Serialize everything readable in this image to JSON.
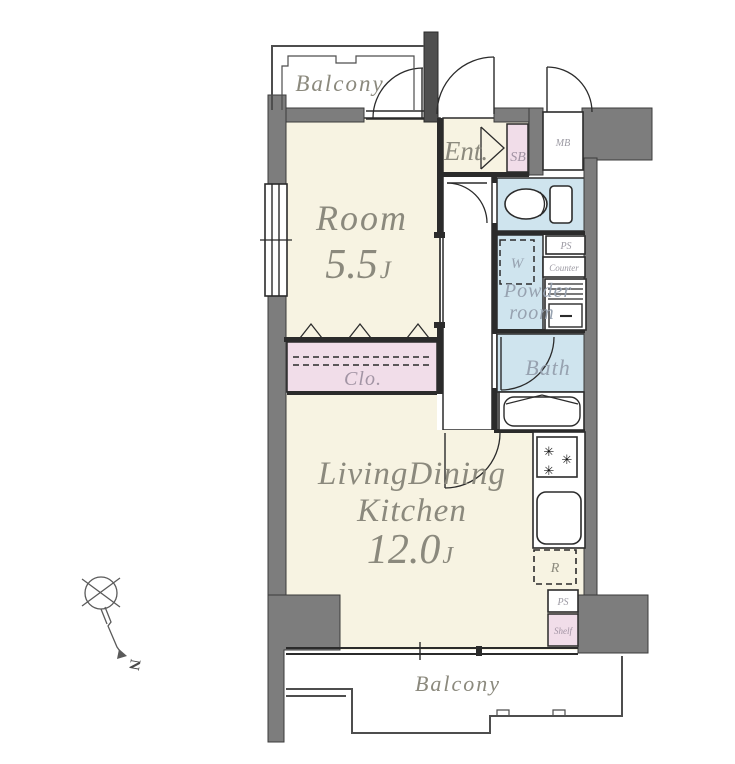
{
  "colors": {
    "wall_gray": "#7d7d7d",
    "floor_cream": "#f7f3e2",
    "wet_area_blue": "#cfe4ee",
    "storage_pink": "#f1dde9",
    "label_gray": "#8b897d",
    "wet_label_blue_gray": "#97a2b0",
    "outline_black": "#2b2b2b"
  },
  "rooms": {
    "balcony_top": {
      "label": "Balcony"
    },
    "room": {
      "label": "Room",
      "size": "5.5",
      "unit": "J"
    },
    "entrance": {
      "label": "Ent."
    },
    "closet": {
      "label": "Clo."
    },
    "powder_room": {
      "line1": "Powder",
      "line2": "room"
    },
    "bath": {
      "label": "Bath"
    },
    "ldk": {
      "line1": "LivingDining",
      "line2": "Kitchen",
      "size": "12.0",
      "unit": "J"
    },
    "balcony_bottom": {
      "label": "Balcony"
    }
  },
  "fixtures": {
    "shoe_box": {
      "label": "SB"
    },
    "meter_box": {
      "label": "MB"
    },
    "washer": {
      "label": "W"
    },
    "pipe_space_upper": {
      "label": "PS"
    },
    "counter": {
      "label": "Counter"
    },
    "refrigerator": {
      "label": "R"
    },
    "pipe_space_lower": {
      "label": "PS"
    },
    "shelf": {
      "label": "Shelf"
    }
  },
  "compass": {
    "north_label": "N"
  }
}
